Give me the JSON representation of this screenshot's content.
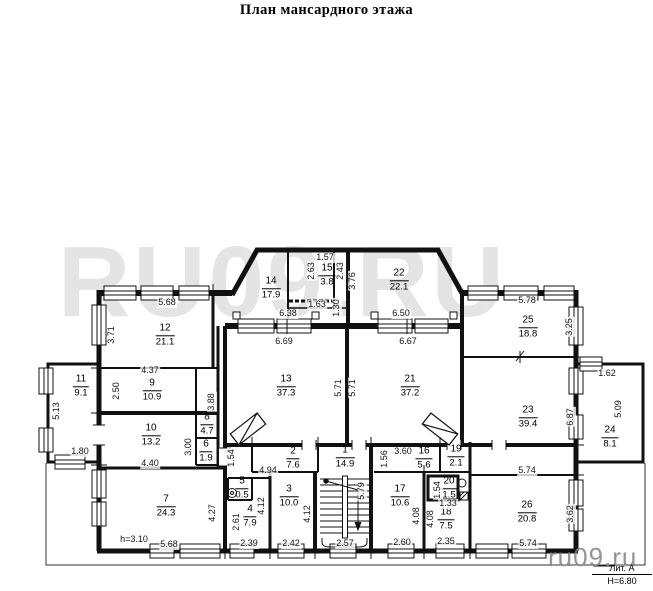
{
  "title": "План мансардного этажа",
  "watermarks": {
    "large": "RU09.RU",
    "small": "ru09.ru"
  },
  "legend": {
    "liter": "Лит. А",
    "height": "Н=6.80"
  },
  "colors": {
    "line": "#111111",
    "watermark_large": "#e4e4e4",
    "watermark_small": "#828282",
    "background": "#ffffff"
  },
  "rooms": [
    {
      "num": "1",
      "area": "14.9",
      "x": 345,
      "y": 457
    },
    {
      "num": "2",
      "area": "7.6",
      "x": 293,
      "y": 458
    },
    {
      "num": "3",
      "area": "10.0",
      "x": 289,
      "y": 496
    },
    {
      "num": "4",
      "area": "7.9",
      "x": 250,
      "y": 516
    },
    {
      "num": "5",
      "area": "0.5",
      "x": 242,
      "y": 488
    },
    {
      "num": "6",
      "area": "1.9",
      "x": 206,
      "y": 451
    },
    {
      "num": "7",
      "area": "24.3",
      "x": 166,
      "y": 506
    },
    {
      "num": "8",
      "area": "4.7",
      "x": 207,
      "y": 424
    },
    {
      "num": "9",
      "area": "10.9",
      "x": 152,
      "y": 390
    },
    {
      "num": "10",
      "area": "13.2",
      "x": 151,
      "y": 435
    },
    {
      "num": "11",
      "area": "9.1",
      "x": 81,
      "y": 386
    },
    {
      "num": "12",
      "area": "21.1",
      "x": 165,
      "y": 335
    },
    {
      "num": "13",
      "area": "37.3",
      "x": 286,
      "y": 386
    },
    {
      "num": "14",
      "area": "17.9",
      "x": 271,
      "y": 288
    },
    {
      "num": "15",
      "area": "3.8",
      "x": 327,
      "y": 275
    },
    {
      "num": "16",
      "area": "5.6",
      "x": 424,
      "y": 458
    },
    {
      "num": "17",
      "area": "10.6",
      "x": 400,
      "y": 496
    },
    {
      "num": "18",
      "area": "7.5",
      "x": 446,
      "y": 519
    },
    {
      "num": "19",
      "area": "2.1",
      "x": 456,
      "y": 456
    },
    {
      "num": "20",
      "area": "1.5",
      "x": 449,
      "y": 488
    },
    {
      "num": "21",
      "area": "37.2",
      "x": 410,
      "y": 386
    },
    {
      "num": "22",
      "area": "22.1",
      "x": 399,
      "y": 280
    },
    {
      "num": "23",
      "area": "39.4",
      "x": 528,
      "y": 417
    },
    {
      "num": "24",
      "area": "8.1",
      "x": 610,
      "y": 437
    },
    {
      "num": "25",
      "area": "18.8",
      "x": 528,
      "y": 327
    },
    {
      "num": "26",
      "area": "20.8",
      "x": 527,
      "y": 512
    }
  ],
  "dims": [
    {
      "text": "5.68",
      "x": 167,
      "y": 303
    },
    {
      "text": "3.71",
      "x": 112,
      "y": 335,
      "v": 1
    },
    {
      "text": "4.37",
      "x": 150,
      "y": 371
    },
    {
      "text": "2.50",
      "x": 117,
      "y": 391,
      "v": 1
    },
    {
      "text": "5.13",
      "x": 57,
      "y": 411,
      "v": 1
    },
    {
      "text": "1.80",
      "x": 80,
      "y": 452
    },
    {
      "text": "3.88",
      "x": 212,
      "y": 402,
      "v": 1
    },
    {
      "text": "3.00",
      "x": 189,
      "y": 447,
      "v": 1
    },
    {
      "text": "4.40",
      "x": 150,
      "y": 464
    },
    {
      "text": "4.27",
      "x": 213,
      "y": 513,
      "v": 1
    },
    {
      "text": "h=3.10",
      "x": 134,
      "y": 540
    },
    {
      "text": "5.68",
      "x": 169,
      "y": 545
    },
    {
      "text": "1.54",
      "x": 232,
      "y": 458,
      "v": 1
    },
    {
      "text": "4.94",
      "x": 268,
      "y": 471
    },
    {
      "text": "2.61",
      "x": 237,
      "y": 522,
      "v": 1
    },
    {
      "text": "2.39",
      "x": 249,
      "y": 544
    },
    {
      "text": "4.12",
      "x": 262,
      "y": 506,
      "v": 1
    },
    {
      "text": "4.12",
      "x": 308,
      "y": 514,
      "v": 1
    },
    {
      "text": "2.42",
      "x": 291,
      "y": 544
    },
    {
      "text": "2.57",
      "x": 345,
      "y": 544
    },
    {
      "text": "5.79",
      "x": 362,
      "y": 491,
      "v": 1
    },
    {
      "text": "1.56",
      "x": 385,
      "y": 459,
      "v": 1
    },
    {
      "text": "3.60",
      "x": 403,
      "y": 452
    },
    {
      "text": "2.60",
      "x": 402,
      "y": 543
    },
    {
      "text": "4.08",
      "x": 417,
      "y": 516,
      "v": 1
    },
    {
      "text": "4.08",
      "x": 431,
      "y": 519,
      "v": 1
    },
    {
      "text": "1.54",
      "x": 438,
      "y": 490,
      "v": 1
    },
    {
      "text": "1.33",
      "x": 448,
      "y": 504
    },
    {
      "text": "2.35",
      "x": 446,
      "y": 542
    },
    {
      "text": "5.74",
      "x": 527,
      "y": 471
    },
    {
      "text": "5.74",
      "x": 528,
      "y": 544
    },
    {
      "text": "3.62",
      "x": 571,
      "y": 514,
      "v": 1
    },
    {
      "text": "6.87",
      "x": 571,
      "y": 417,
      "v": 1
    },
    {
      "text": "1.62",
      "x": 607,
      "y": 374
    },
    {
      "text": "5.09",
      "x": 619,
      "y": 409,
      "v": 1
    },
    {
      "text": "3.25",
      "x": 570,
      "y": 327,
      "v": 1
    },
    {
      "text": "5.78",
      "x": 527,
      "y": 301
    },
    {
      "text": "6.38",
      "x": 288,
      "y": 314
    },
    {
      "text": "6.50",
      "x": 401,
      "y": 314
    },
    {
      "text": "6.69",
      "x": 284,
      "y": 342
    },
    {
      "text": "6.67",
      "x": 408,
      "y": 342
    },
    {
      "text": "5.71",
      "x": 339,
      "y": 388,
      "v": 1
    },
    {
      "text": "5.71",
      "x": 353,
      "y": 388,
      "v": 1
    },
    {
      "text": "1.57",
      "x": 325,
      "y": 258
    },
    {
      "text": "2.63",
      "x": 312,
      "y": 271,
      "v": 1
    },
    {
      "text": "2.43",
      "x": 341,
      "y": 271,
      "v": 1
    },
    {
      "text": "1.63",
      "x": 317,
      "y": 305
    },
    {
      "text": "1.30",
      "x": 337,
      "y": 308,
      "v": 1
    },
    {
      "text": "3.76",
      "x": 353,
      "y": 281,
      "v": 1
    }
  ]
}
